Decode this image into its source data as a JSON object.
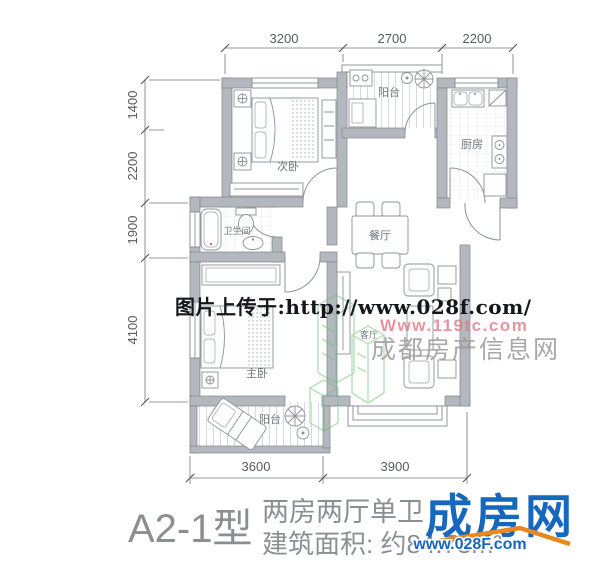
{
  "plan": {
    "rooms": {
      "secondary_bedroom": "次卧",
      "balcony_top": "阳台",
      "kitchen": "厨房",
      "dining_room": "餐厅",
      "bathroom": "卫生间",
      "master_bedroom": "主卧",
      "living_room": "客厅",
      "balcony_bottom": "阳台"
    },
    "dimensions": {
      "top": [
        "3200",
        "2700",
        "2200"
      ],
      "left": [
        "1400",
        "2200",
        "1900",
        "4100"
      ],
      "bottom": [
        "3600",
        "3900"
      ]
    }
  },
  "watermarks": {
    "upload_text": "图片上传于:http://www.028f.com/",
    "site_url_pink": "Www.119tc.com",
    "site_name": "成都房产信息网"
  },
  "footer": {
    "unit_label": "A2-1型",
    "layout_text": "两房两厅单卫",
    "area_text": "建筑面积: 约84.73m²",
    "logo_text": "成房网",
    "logo_url": "www.028F.com"
  },
  "colors": {
    "wall": "#b3b8be",
    "logo_blue": "#1767bd",
    "logo_orange": "#e8871e",
    "watermark_pink": "#e07a8a",
    "watermark_green": "#6fbf73"
  }
}
